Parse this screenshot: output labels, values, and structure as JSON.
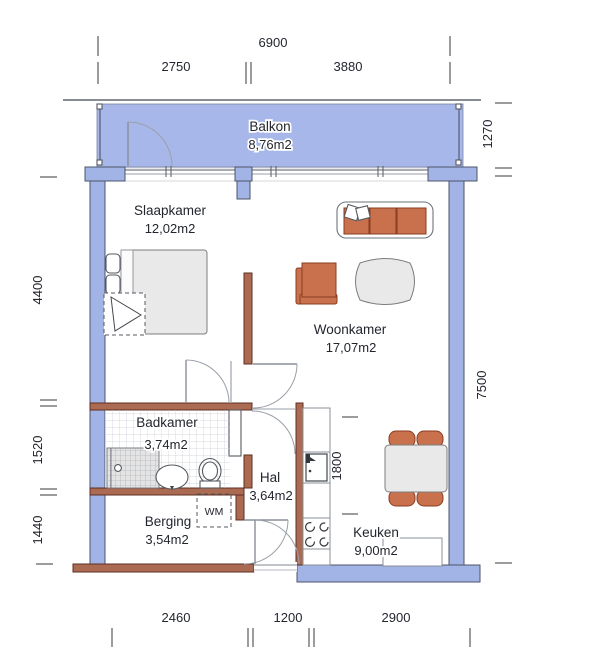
{
  "floorplan": {
    "rooms": [
      {
        "name": "Balkon",
        "area": "8,76m2"
      },
      {
        "name": "Slaapkamer",
        "area": "12,02m2"
      },
      {
        "name": "Woonkamer",
        "area": "17,07m2"
      },
      {
        "name": "Badkamer",
        "area": "3,74m2"
      },
      {
        "name": "Hal",
        "area": "3,64m2"
      },
      {
        "name": "Berging",
        "area": "3,54m2"
      },
      {
        "name": "Keuken",
        "area": "9,00m2"
      }
    ],
    "labels": {
      "washing_machine": "WM"
    },
    "dimensions": {
      "top_total": "6900",
      "top_left": "2750",
      "top_right": "3880",
      "right_balcony": "1270",
      "right_total": "7500",
      "left_upper": "4400",
      "left_middle": "1520",
      "left_lower": "1440",
      "kitchen_counter": "1800",
      "bottom_left": "2460",
      "bottom_middle": "1200",
      "bottom_right": "2900"
    },
    "colors": {
      "exterior_wall": "#a2b3e6",
      "balcony_floor": "#a8b7ea",
      "interior_wall": "#ab6a52",
      "furniture_accent": "#c8714c",
      "furniture_neutral": "#e9e9e9",
      "background": "#ffffff"
    }
  }
}
